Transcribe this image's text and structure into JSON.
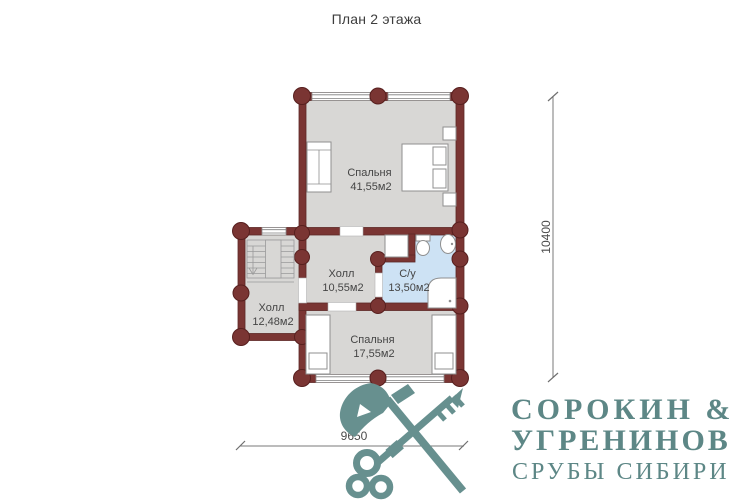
{
  "title": "План 2 этажа",
  "plan": {
    "rooms": [
      {
        "name": "Спальня",
        "area": "41,55м2"
      },
      {
        "name": "Холл",
        "area": "10,55м2"
      },
      {
        "name": "С/у",
        "area": "13,50м2"
      },
      {
        "name": "Холл",
        "area": "12,48м2"
      },
      {
        "name": "Спальня",
        "area": "17,55м2"
      }
    ],
    "dimensions": {
      "vertical": "10400",
      "horizontal": "9650"
    }
  },
  "logo": {
    "name_line1": "СОРОКИН &",
    "name_line2": "УГРЕНИНОВ",
    "tagline": "СРУБЫ СИБИРИ"
  },
  "colors": {
    "wall": "#7a3533",
    "floor": "#d8d7d5",
    "bathroom_floor": "#cde2f4",
    "logo": "#5d8786"
  }
}
